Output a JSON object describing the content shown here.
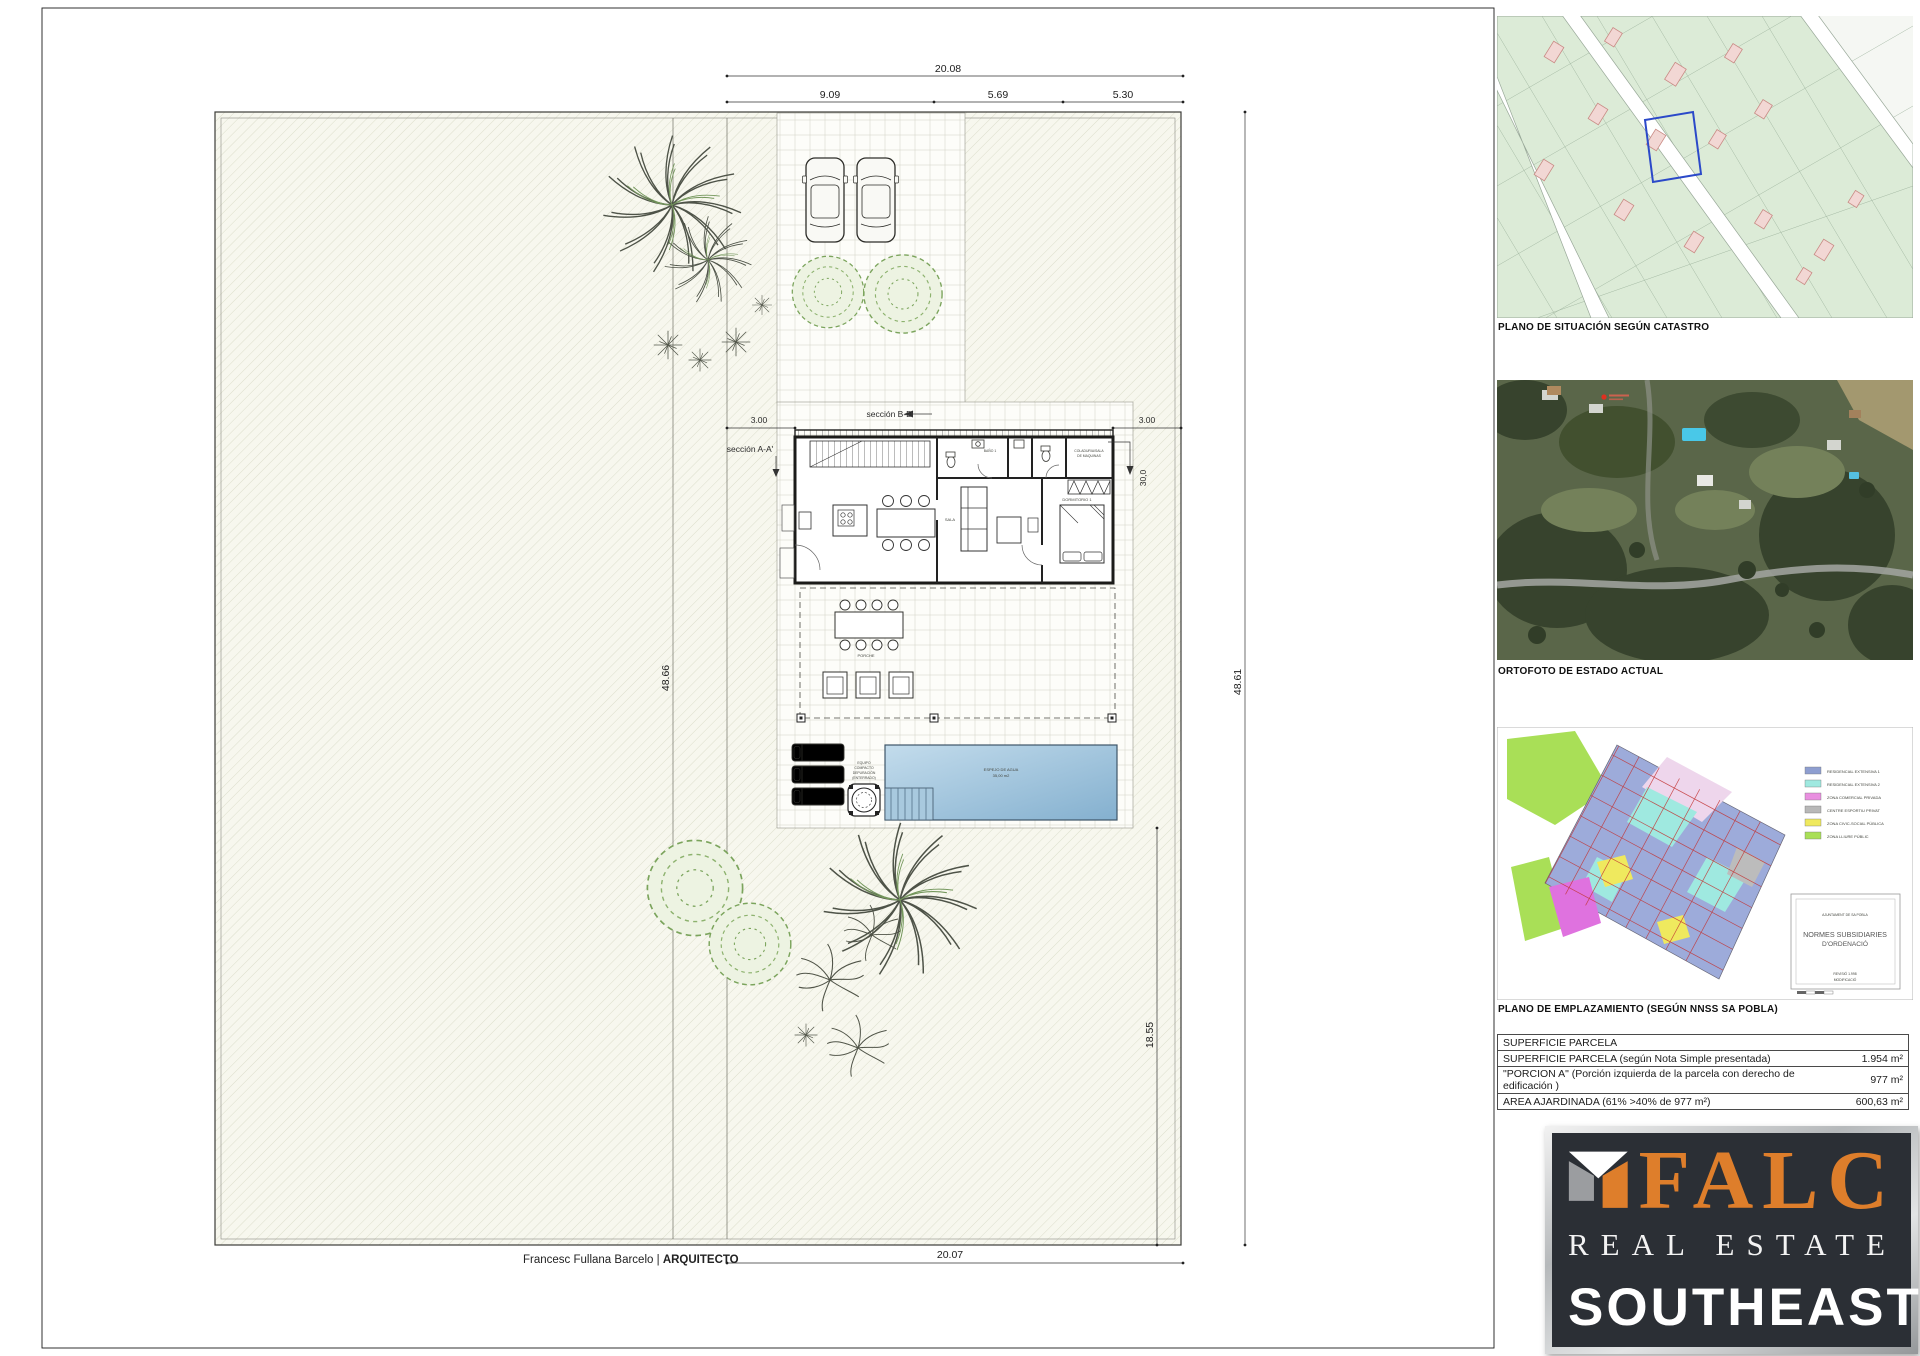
{
  "dims": {
    "top_total": "20.08",
    "seg1": "9.09",
    "seg2": "5.69",
    "seg3": "5.30",
    "setback_left": "3.00",
    "setback_right": "3.00",
    "depth": "30,0",
    "left_height": "48.66",
    "right_height": "48.61",
    "garden_depth": "18.55",
    "bottom_width": "20.07"
  },
  "sections": {
    "a": "sección A-A'",
    "b": "sección B-B'"
  },
  "rooms": {
    "bath1": "BAÑO 1",
    "bedroom1": "DORMITORIO 1",
    "laundry1": "COLADURIA/SALA",
    "laundry2": "DE MAQUINAS",
    "living": "SALA",
    "porch": "PORCHE"
  },
  "pool": {
    "l1": "ESPEJO DE AGUA",
    "l2": "35,00 m2"
  },
  "equipment": {
    "l1": "EQUIPO",
    "l2": "COMPACTO",
    "l3": "DEPURACIÓN",
    "l4": "(ENTERRADO)"
  },
  "footer": {
    "architect": "Francesc Fullana Barcelo",
    "sep": "|",
    "role": "ARQUITECTO"
  },
  "sidebar": {
    "captions": {
      "catastro": "PLANO DE SITUACIÓN SEGÚN CATASTRO",
      "ortofoto": "ORTOFOTO DE ESTADO ACTUAL",
      "emplazamiento": "PLANO DE EMPLAZAMIENTO (SEGÚN NNSS SA POBLA)"
    },
    "legend": [
      {
        "color": "#8e9ed0",
        "label": "RESIDENCIAL EXTENSIVA 1"
      },
      {
        "color": "#9fe9e0",
        "label": "RESIDENCIAL EXTENSIVA 2"
      },
      {
        "color": "#e98fe0",
        "label": "ZONA COMERCIAL PRIVADA"
      },
      {
        "color": "#b8b8b8",
        "label": "CENTRE ESPORTIU PRIVAT"
      },
      {
        "color": "#efe95e",
        "label": "ZONA CIVIC-SOCIAL PÚBLICA"
      },
      {
        "color": "#a9df57",
        "label": "ZONA LLIURE PÚBLIC"
      }
    ],
    "titleblock": {
      "line1": "AJUNTAMENT DE SA POBLA",
      "line2": "NORMES SUBSIDIARIES",
      "line3": "D'ORDENACIÓ",
      "line4": "REVISIÓ 1.998",
      "line5": "MODIFICACIÓ"
    },
    "table": {
      "title": "SUPERFICIE PARCELA",
      "rows": [
        {
          "label": "SUPERFICIE PARCELA (según Nota Simple presentada)",
          "value": "1.954 m²"
        },
        {
          "label": "\"PORCION A\"  (Porción izquierda de la parcela con derecho de edificación )",
          "value": "977 m²"
        },
        {
          "label": "AREA AJARDINADA (61% >40% de 977 m²)",
          "value": "600,63 m²"
        }
      ]
    },
    "logo": {
      "brand": "FALC",
      "line2": "REAL ESTATE",
      "line3": "SOUTHEAST"
    }
  }
}
